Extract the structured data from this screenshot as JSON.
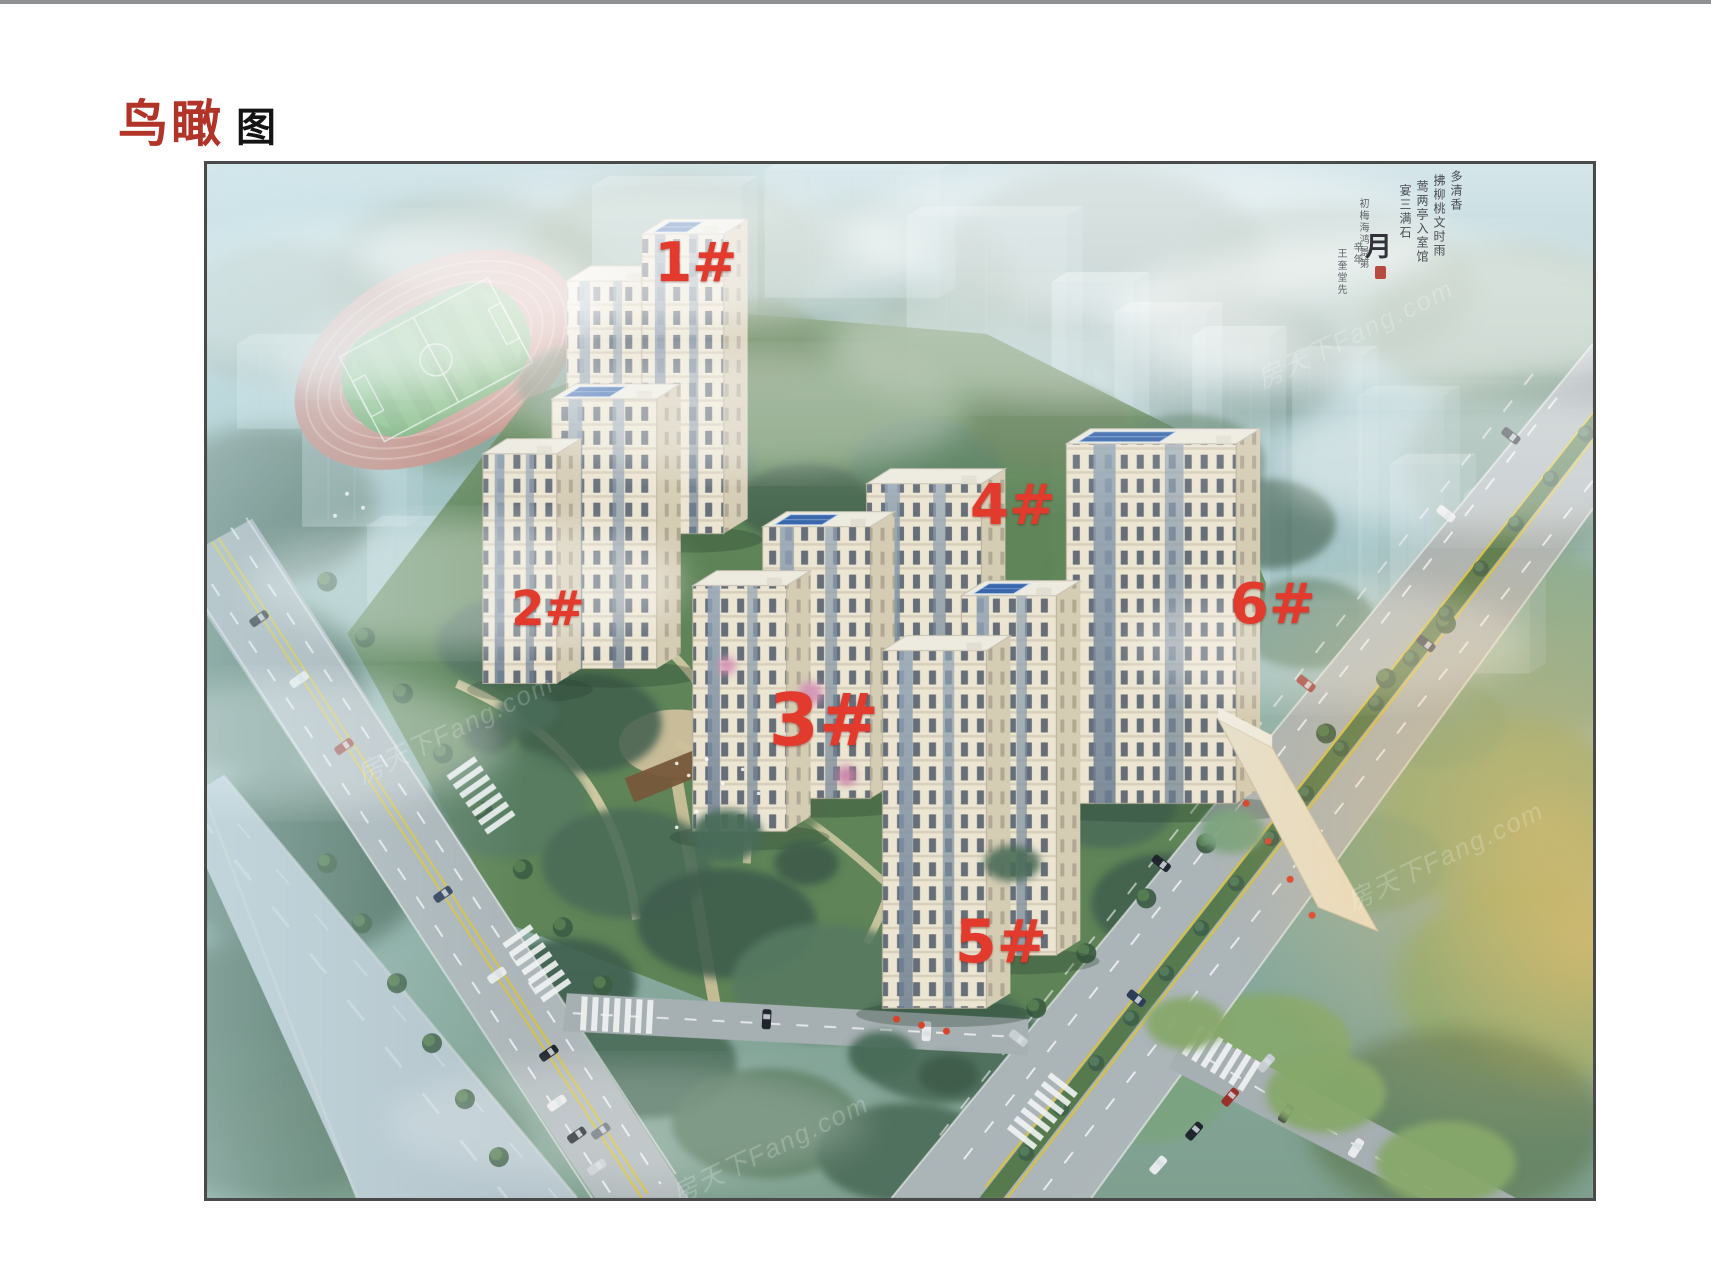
{
  "page": {
    "title": {
      "primary": "鸟瞰",
      "secondary": "图"
    }
  },
  "scene": {
    "labels": [
      {
        "text": "1#"
      },
      {
        "text": "2#"
      },
      {
        "text": "3#"
      },
      {
        "text": "4#"
      },
      {
        "text": "5#"
      },
      {
        "text": "6#"
      }
    ],
    "watermark_text": "房天下Fang.com",
    "calligraphy": {
      "columns": [
        "多清香",
        "拂柳桃文时雨",
        "莺两亭入室馆",
        "宴三满石"
      ],
      "small_column": "初梅海鸿景第",
      "large_char": "月",
      "signature_top": "辛年",
      "signature": "王奎堂先"
    },
    "colors": {
      "label_red": "#e23a2c",
      "title_red": "#b23327",
      "track_pink": "#c6857b",
      "field_green": "#64a55e",
      "facade_cream": "#ece5d2",
      "solar_blue": "#3a66ab",
      "haze_blue": "#a9c9cf"
    }
  }
}
